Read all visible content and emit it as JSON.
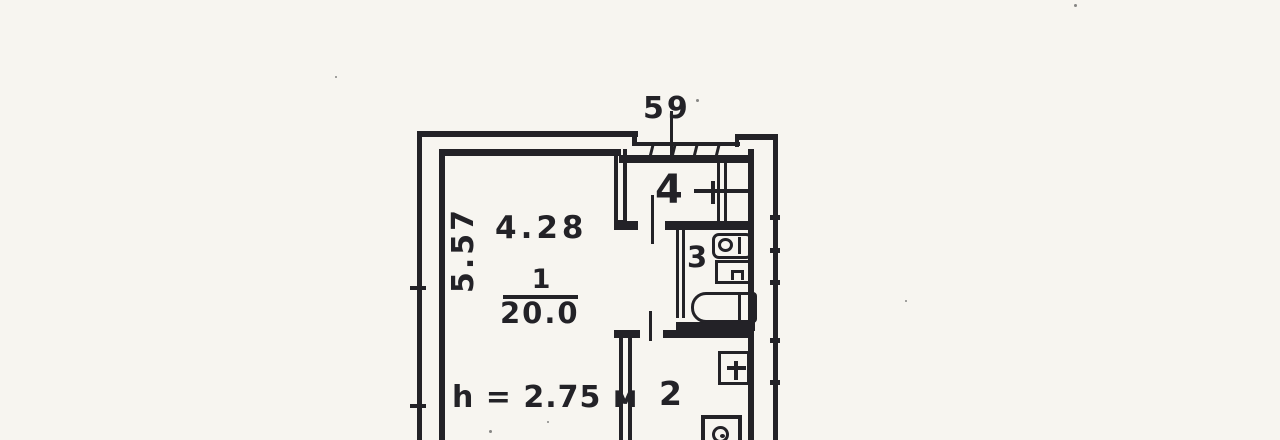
{
  "plan": {
    "apartment_number": "59",
    "rooms": [
      {
        "key": "room-1",
        "number": "1",
        "area": "20.0",
        "width": "4.28",
        "depth": "5.57",
        "height_note": "h = 2.75 м"
      },
      {
        "key": "room-2",
        "number": "2"
      },
      {
        "key": "room-3",
        "number": "3"
      },
      {
        "key": "room-4",
        "number": "4"
      }
    ],
    "fixtures": {
      "room_3": [
        "toilet",
        "wash-basin",
        "bathtub"
      ],
      "room_2": [
        "kitchen-sink",
        "stove"
      ]
    },
    "colors": {
      "ink": "#232227",
      "paper": "#f7f5f0"
    }
  }
}
